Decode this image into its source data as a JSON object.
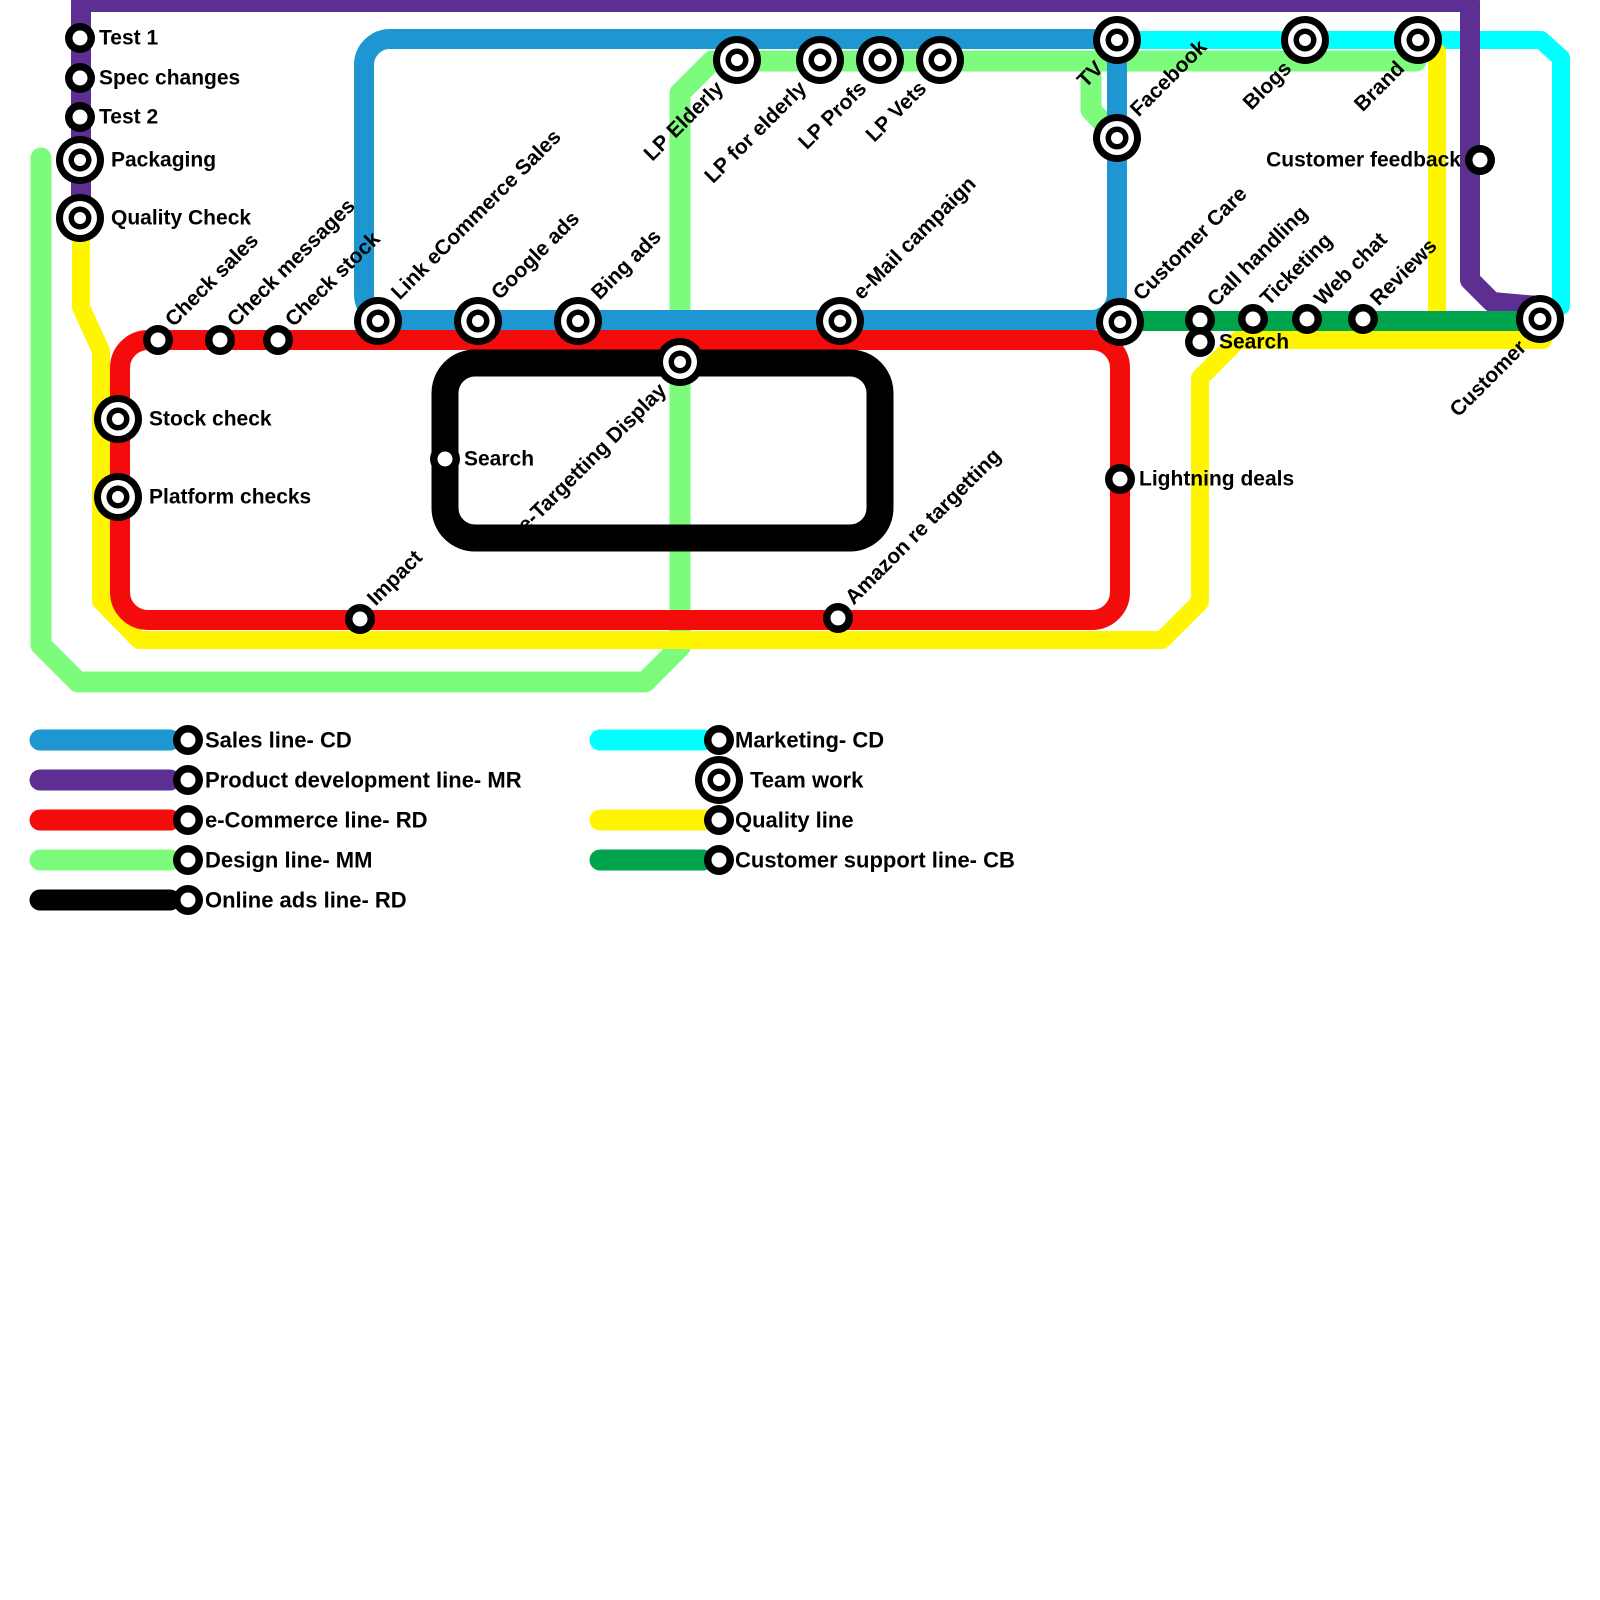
{
  "map": {
    "background": "#FFFFFF",
    "lines": [
      {
        "id": "design-line",
        "name": "Design line- MM",
        "color": "#7DFB7D",
        "width": 21,
        "kind": "poly",
        "points": [
          [
            41,
            158
          ],
          [
            41,
            645
          ],
          [
            78,
            682
          ],
          [
            645,
            682
          ],
          [
            680,
            647
          ],
          [
            680,
            93
          ],
          [
            712,
            61
          ],
          [
            1416,
            61
          ]
        ]
      },
      {
        "id": "design-branch-facebook",
        "name": "Design line- MM branch",
        "color": "#7DFB7D",
        "width": 21,
        "kind": "poly",
        "points": [
          [
            1091,
            61
          ],
          [
            1091,
            110
          ],
          [
            1115,
            135
          ]
        ]
      },
      {
        "id": "marketing-line",
        "name": "Marketing- CD",
        "color": "#00FFFF",
        "width": 18,
        "kind": "poly",
        "points": [
          [
            1117,
            40
          ],
          [
            1541,
            40
          ],
          [
            1561,
            58
          ],
          [
            1561,
            306
          ]
        ]
      },
      {
        "id": "sales-line",
        "name": "Sales line- CD",
        "color": "#1E96D2",
        "width": 20,
        "kind": "rect",
        "rect": [
          364,
          39,
          753,
          281
        ],
        "rx": 26
      },
      {
        "id": "product-development-line",
        "name": "Product development line- MR",
        "color": "#5E2F92",
        "width": 20,
        "kind": "poly",
        "points": [
          [
            81,
            214
          ],
          [
            81,
            2
          ],
          [
            1470,
            2
          ],
          [
            1470,
            280
          ],
          [
            1492,
            302
          ],
          [
            1538,
            306
          ]
        ]
      },
      {
        "id": "quality-line",
        "name": "Quality line",
        "color": "#FFF500",
        "width": 18,
        "kind": "poly",
        "points": [
          [
            81,
            220
          ],
          [
            81,
            307
          ],
          [
            101,
            351
          ],
          [
            101,
            601
          ],
          [
            139,
            640
          ],
          [
            1162,
            640
          ],
          [
            1200,
            602
          ],
          [
            1200,
            378
          ],
          [
            1238,
            340
          ],
          [
            1543,
            340
          ]
        ]
      },
      {
        "id": "quality-branch-brand",
        "name": "Quality line branch",
        "color": "#FFF500",
        "width": 18,
        "kind": "poly",
        "points": [
          [
            1437,
            52
          ],
          [
            1437,
            339
          ]
        ]
      },
      {
        "id": "ecommerce-line",
        "name": "e-Commerce line- RD",
        "color": "#F40B0B",
        "width": 20,
        "kind": "rect",
        "rect": [
          120,
          340,
          1000,
          280
        ],
        "rx": 28
      },
      {
        "id": "customer-support-line",
        "name": "Customer support line- CB",
        "color": "#00A44C",
        "width": 20,
        "kind": "poly",
        "points": [
          [
            1120,
            321
          ],
          [
            1541,
            321
          ]
        ]
      },
      {
        "id": "online-ads-line",
        "name": "Online ads line- RD",
        "color": "#000000",
        "width": 27,
        "kind": "rect",
        "rect": [
          445,
          363,
          435,
          175
        ],
        "rx": 30
      }
    ],
    "stations": [
      {
        "id": "test-1",
        "label": "Test 1",
        "x": 80,
        "y": 38,
        "size": "stop",
        "label_pos": "right"
      },
      {
        "id": "spec-changes",
        "label": "Spec changes",
        "x": 80,
        "y": 78,
        "size": "stop",
        "label_pos": "right"
      },
      {
        "id": "test-2",
        "label": "Test 2",
        "x": 80,
        "y": 117,
        "size": "stop",
        "label_pos": "right"
      },
      {
        "id": "packaging",
        "label": "Packaging",
        "x": 80,
        "y": 160,
        "size": "interchange",
        "label_pos": "right"
      },
      {
        "id": "quality-check",
        "label": "Quality Check",
        "x": 80,
        "y": 218,
        "size": "interchange",
        "label_pos": "right"
      },
      {
        "id": "check-sales",
        "label": "Check sales",
        "x": 158,
        "y": 340,
        "size": "stop",
        "label_pos": "diag-up"
      },
      {
        "id": "check-messages",
        "label": "Check messages",
        "x": 220,
        "y": 340,
        "size": "stop",
        "label_pos": "diag-up"
      },
      {
        "id": "check-stock",
        "label": "Check stock",
        "x": 278,
        "y": 340,
        "size": "stop",
        "label_pos": "diag-up"
      },
      {
        "id": "link-ecommerce-sales",
        "label": "Link eCommerce Sales",
        "x": 378,
        "y": 321,
        "size": "interchange",
        "label_pos": "diag-up"
      },
      {
        "id": "google-ads",
        "label": "Google ads",
        "x": 478,
        "y": 321,
        "size": "interchange",
        "label_pos": "diag-up"
      },
      {
        "id": "bing-ads",
        "label": "Bing ads",
        "x": 578,
        "y": 321,
        "size": "interchange",
        "label_pos": "diag-up"
      },
      {
        "id": "email-campaign",
        "label": "e-Mail campaign",
        "x": 840,
        "y": 321,
        "size": "interchange",
        "label_pos": "diag-up"
      },
      {
        "id": "lp-elderly",
        "label": "LP Elderly",
        "x": 737,
        "y": 60,
        "size": "interchange",
        "label_pos": "diag-down"
      },
      {
        "id": "lp-for-elderly",
        "label": "LP for elderly",
        "x": 820,
        "y": 60,
        "size": "interchange",
        "label_pos": "diag-down"
      },
      {
        "id": "lp-profs",
        "label": "LP Profs",
        "x": 880,
        "y": 60,
        "size": "interchange",
        "label_pos": "diag-down"
      },
      {
        "id": "lp-vets",
        "label": "LP Vets",
        "x": 940,
        "y": 60,
        "size": "interchange",
        "label_pos": "diag-down"
      },
      {
        "id": "tv",
        "label": "TV",
        "x": 1117,
        "y": 40,
        "size": "interchange",
        "label_pos": "diag-down"
      },
      {
        "id": "facebook",
        "label": "Facebook",
        "x": 1117,
        "y": 138,
        "size": "interchange",
        "label_pos": "diag-up"
      },
      {
        "id": "blogs",
        "label": "Blogs",
        "x": 1305,
        "y": 40,
        "size": "interchange",
        "label_pos": "diag-down"
      },
      {
        "id": "brand",
        "label": "Brand",
        "x": 1418,
        "y": 40,
        "size": "interchange",
        "label_pos": "diag-down"
      },
      {
        "id": "customer-feedback",
        "label": "Customer feedback",
        "x": 1480,
        "y": 160,
        "size": "stop",
        "label_pos": "left"
      },
      {
        "id": "customer-care",
        "label": "Customer Care",
        "x": 1120,
        "y": 322,
        "size": "interchange",
        "label_pos": "diag-up"
      },
      {
        "id": "call-handling",
        "label": "Call handling",
        "x": 1200,
        "y": 320,
        "size": "stop",
        "label_pos": "diag-up"
      },
      {
        "id": "ticketing",
        "label": "Ticketing",
        "x": 1253,
        "y": 319,
        "size": "stop",
        "label_pos": "diag-up"
      },
      {
        "id": "web-chat",
        "label": "Web chat",
        "x": 1307,
        "y": 319,
        "size": "stop",
        "label_pos": "diag-up"
      },
      {
        "id": "reviews",
        "label": "Reviews",
        "x": 1363,
        "y": 319,
        "size": "stop",
        "label_pos": "diag-up"
      },
      {
        "id": "search-support",
        "label": "Search",
        "x": 1200,
        "y": 342,
        "size": "stop",
        "label_pos": "right"
      },
      {
        "id": "customer",
        "label": "Customer",
        "x": 1540,
        "y": 319,
        "size": "interchange",
        "label_pos": "diag-down"
      },
      {
        "id": "stock-check",
        "label": "Stock check",
        "x": 118,
        "y": 419,
        "size": "interchange",
        "label_pos": "right"
      },
      {
        "id": "platform-checks",
        "label": "Platform checks",
        "x": 118,
        "y": 497,
        "size": "interchange",
        "label_pos": "right"
      },
      {
        "id": "retargetting-display",
        "label": "Re-Targetting Display",
        "x": 680,
        "y": 362,
        "size": "interchange",
        "label_pos": "diag-down"
      },
      {
        "id": "search-ads",
        "label": "Search",
        "x": 445,
        "y": 459,
        "size": "stop",
        "label_pos": "right"
      },
      {
        "id": "lightning-deals",
        "label": "Lightning deals",
        "x": 1120,
        "y": 479,
        "size": "stop",
        "label_pos": "right"
      },
      {
        "id": "impact",
        "label": "Impact",
        "x": 360,
        "y": 619,
        "size": "stop",
        "label_pos": "diag-up"
      },
      {
        "id": "amazon-re-targetting",
        "label": "Amazon re targetting",
        "x": 838,
        "y": 618,
        "size": "stop",
        "label_pos": "diag-up"
      }
    ]
  },
  "legend": {
    "columns": [
      {
        "items": [
          {
            "id": "sales",
            "label": "Sales line- CD",
            "color": "#1E96D2",
            "marker": "stop"
          },
          {
            "id": "product-development",
            "label": "Product development line- MR",
            "color": "#5E2F92",
            "marker": "stop"
          },
          {
            "id": "ecommerce",
            "label": "e-Commerce line- RD",
            "color": "#F40B0B",
            "marker": "stop"
          },
          {
            "id": "design",
            "label": "Design line- MM",
            "color": "#7DFB7D",
            "marker": "stop"
          },
          {
            "id": "online-ads",
            "label": "Online ads line- RD",
            "color": "#000000",
            "marker": "stop"
          }
        ]
      },
      {
        "items": [
          {
            "id": "marketing",
            "label": "Marketing- CD",
            "color": "#00FFFF",
            "marker": "stop"
          },
          {
            "id": "team-work",
            "label": "Team work",
            "color": null,
            "marker": "interchange"
          },
          {
            "id": "quality",
            "label": "Quality line",
            "color": "#FFF500",
            "marker": "stop"
          },
          {
            "id": "customer-support",
            "label": "Customer support line- CB",
            "color": "#00A44C",
            "marker": "stop"
          }
        ]
      }
    ]
  },
  "style": {
    "label_color": "#000000",
    "station_ring": "#000000",
    "station_fill": "#FFFFFF"
  }
}
